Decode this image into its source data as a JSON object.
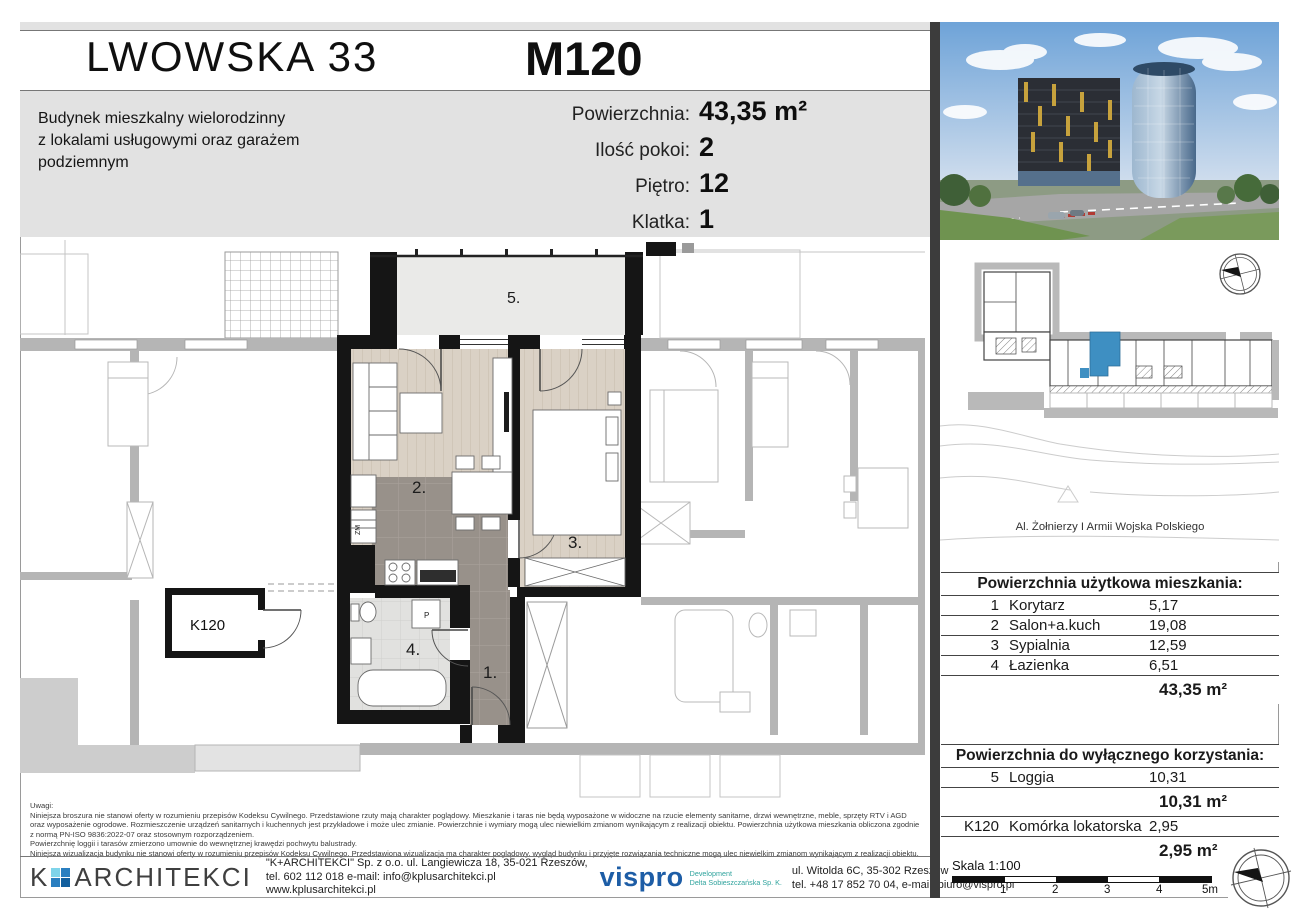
{
  "header": {
    "project_title": "LWOWSKA 33",
    "unit_id": "M120",
    "subtitle": "Budynek mieszkalny wielorodzinny\nz lokalami usługowymi oraz garażem\npodziemnym",
    "specs": [
      {
        "label": "Powierzchnia:",
        "value": "43,35 m²"
      },
      {
        "label": "Ilość pokoi:",
        "value": "2"
      },
      {
        "label": "Piętro:",
        "value": "12"
      },
      {
        "label": "Klatka:",
        "value": "1"
      }
    ]
  },
  "floor_plan": {
    "labels": {
      "room1": "1.",
      "room2": "2.",
      "room3": "3.",
      "room4": "4.",
      "room5": "5.",
      "storage": "K120",
      "washer": "P",
      "dishwasher": "ZM"
    }
  },
  "site_plan": {
    "street_label": "Al. Żołnierzy I Armii Wojska Polskiego",
    "highlight_color": "#3e8fc2"
  },
  "usable_area_table": {
    "title": "Powierzchnia użytkowa mieszkania:",
    "rows": [
      {
        "no": "1",
        "name": "Korytarz",
        "area": "5,17"
      },
      {
        "no": "2",
        "name": "Salon+a.kuch",
        "area": "19,08"
      },
      {
        "no": "3",
        "name": "Sypialnia",
        "area": "12,59"
      },
      {
        "no": "4",
        "name": "Łazienka",
        "area": "6,51"
      }
    ],
    "total": "43,35 m²"
  },
  "exclusive_area_table": {
    "title": "Powierzchnia do wyłącznego korzystania:",
    "rows": [
      {
        "no": "5",
        "name": "Loggia",
        "area": "10,31"
      }
    ],
    "total1": "10,31 m²",
    "rows2": [
      {
        "no": "K120",
        "name": "Komórka lokatorska",
        "area": "2,95"
      }
    ],
    "total2": "2,95 m²"
  },
  "notes": {
    "title": "Uwagi:",
    "paragraphs": [
      "Niniejsza broszura nie stanowi oferty w rozumieniu przepisów Kodeksu Cywilnego. Przedstawione rzuty mają charakter poglądowy. Mieszkanie i taras nie będą wyposażone w widoczne na rzucie elementy sanitarne, drzwi wewnętrzne, meble, sprzęty RTV i AGD oraz wyposażenie ogrodowe. Rozmieszczenie urządzeń sanitarnych i kuchennych jest przykładowe i może ulec zmianie. Powierzchnie i wymiary mogą ulec niewielkim zmianom wynikającym z realizacji obiektu. Powierzchnia użytkowa mieszkania obliczona zgodnie z normą PN-ISO 9836:2022-07 oraz stosownym rozporządzeniem.",
      "Powierzchnię loggii i tarasów zmierzono umownie do wewnętrznej krawędzi pochwytu balustrady.",
      "Niniejsza wizualizacja budynku nie stanowi oferty w rozumieniu przepisów Kodeksu Cywilnego. Przedstawiona wizualizacja ma charakter poglądowy, wygląd budynku i przyjęte rozwiązania techniczne mogą ulec niewielkim zmianom wynikającym z realizacji obiektu."
    ]
  },
  "footer": {
    "architect_logo_k": "K",
    "architect_logo_name": "ARCHITEKCI",
    "architect_addr1": "\"K+ARCHITEKCI\" Sp. z o.o. ul. Langiewicza 18, 35-021 Rzeszów,",
    "architect_addr2": "tel. 602 112 018 e-mail: info@kplusarchitekci.pl",
    "architect_addr3": "www.kplusarchitekci.pl",
    "developer_logo": "vispro",
    "developer_sub1": "Development",
    "developer_sub2": "Delta Sobieszczańska Sp. K.",
    "developer_addr1": "ul. Witolda 6C, 35-302 Rzeszów",
    "developer_addr2": "tel. +48 17 852 70 04, e-mail: biuro@vispro.pl"
  },
  "scale_bar": {
    "label": "Skala 1:100",
    "ticks": [
      "1",
      "2",
      "3",
      "4",
      "5m"
    ]
  },
  "colors": {
    "header_bg": "#e2e2e2",
    "wall_black": "#151515",
    "wood_floor": "#dad1c5",
    "tile_dark": "#98918a",
    "tile_light": "#e1e1df",
    "neighbor_gray": "#b5b5b5",
    "unit_highlight": "#3e8fc2",
    "vispro_blue": "#1d5da6",
    "vispro_teal": "#2fa39d",
    "logo_cyan": "#7fd4ea",
    "logo_blue": "#2a7fc0"
  }
}
